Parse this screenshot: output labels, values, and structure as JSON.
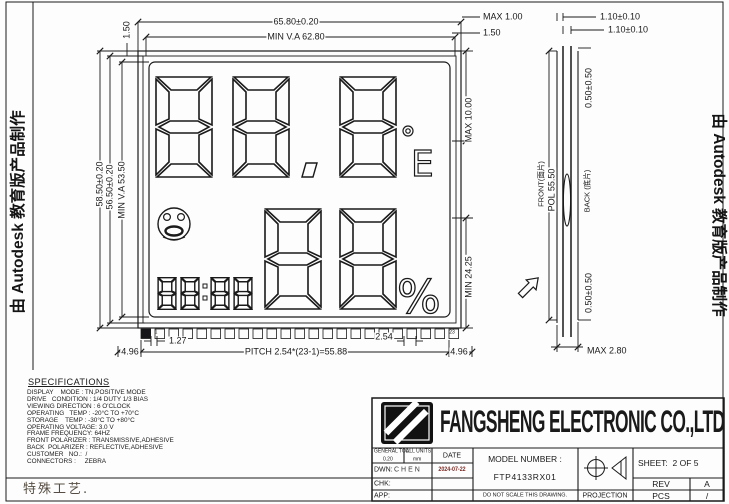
{
  "watermarks": {
    "left": "由 Autodesk 教育版产品制作",
    "right": "由 Autodesk 教育版产品制作"
  },
  "front_view": {
    "dim_width": "65.80±0.20",
    "dim_va_width": "MIN  V.A  62.80",
    "dim_offset_left": "1.50",
    "dim_max_top_right": "MAX  1.00",
    "dim_top_right2": "1.50",
    "dim_height": "58.50±0.20",
    "dim_height2": "56.50±0.20",
    "dim_va_height": "MIN  V.A  53.50",
    "dim_digit_top": "MAX  10.00",
    "dim_digit_bottom": "MIN  24.25",
    "dim_pin_left_margin": "4.96",
    "dim_pin_gap": "1.27",
    "dim_pitch": "PITCH  2.54*(23-1)=55.88",
    "dim_pin_pitch": "2.54",
    "dim_pin_right_margin": "4.96",
    "pin_count": 23,
    "pin_first": "1",
    "pin_last": "23",
    "lcd": {
      "reading_top": "88.8",
      "unit_top_glyph": "E",
      "degree_icon": "degree-ring",
      "smiley_icon": "comfort-face",
      "clock": "88:88",
      "reading_bottom": "88",
      "unit_bottom": "%"
    }
  },
  "side_view": {
    "dim_glass1": "1.10±0.10",
    "dim_glass2": "1.10±0.10",
    "dim_pol_offset_top": "0.50±0.50",
    "dim_pol_offset_bottom": "0.50±0.50",
    "label_front": "FRONT(面片)",
    "label_pol": "POL 55.50",
    "label_back": "BACK (底片)",
    "dim_total_thickness": "MAX  2.80"
  },
  "specifications": {
    "title": "SPECIFICATIONS",
    "rows": [
      "DISPLAY    MODE : TN,POSITIVE MODE",
      "DRIVE   CONDITION : 1/4 DUTY 1/3 BIAS",
      "VIEWING DIRECTION : 6 O'CLOCK",
      "OPERATING   TEMP : -20°C TO +70°C",
      "STORAGE    TEMP : -30°C TO +80°C",
      "OPERATING VOLTAGE: 3.0 V",
      "FRAME FREQUENCY: 64HZ",
      "FRONT POLARIZER : TRANSMISSIVE,ADHESIVE",
      "BACK  POLARIZER : REFLECTIVE,ADHESIVE",
      "CUSTOMER   NO.:  /",
      "CONNECTORS :     ZEBRA"
    ]
  },
  "special_note": "特殊工艺.",
  "title_block": {
    "company": "FANGSHENG ELECTRONIC CO.,LTD",
    "general_tol_label": "GENERAL TOL:",
    "general_tol_value": "0.20",
    "units_label": "ALL UNITS:",
    "units_value": "mm",
    "date_label": "DATE",
    "dwn_label": "DWN:",
    "dwn_value": "CHEN",
    "date_value": "2024-07-22",
    "chk_label": "CHK:",
    "app_label": "APP:",
    "model_label": "MODEL NUMBER :",
    "model_value": "FTP4133RX01",
    "no_scale_note": "DO NOT SCALE THIS DRAWING.",
    "projection_label": "PROJECTION",
    "sheet_label": "SHEET:",
    "sheet_value": "2 OF 5",
    "rev_label": "REV",
    "rev_value": "A",
    "pcs_label": "PCS",
    "pcs_value": "/"
  },
  "colors": {
    "line_ink": "#1a1a1a",
    "date_ink": "#7a2a24",
    "note_ink": "#564e44",
    "pin1_marker": "#15151a"
  }
}
